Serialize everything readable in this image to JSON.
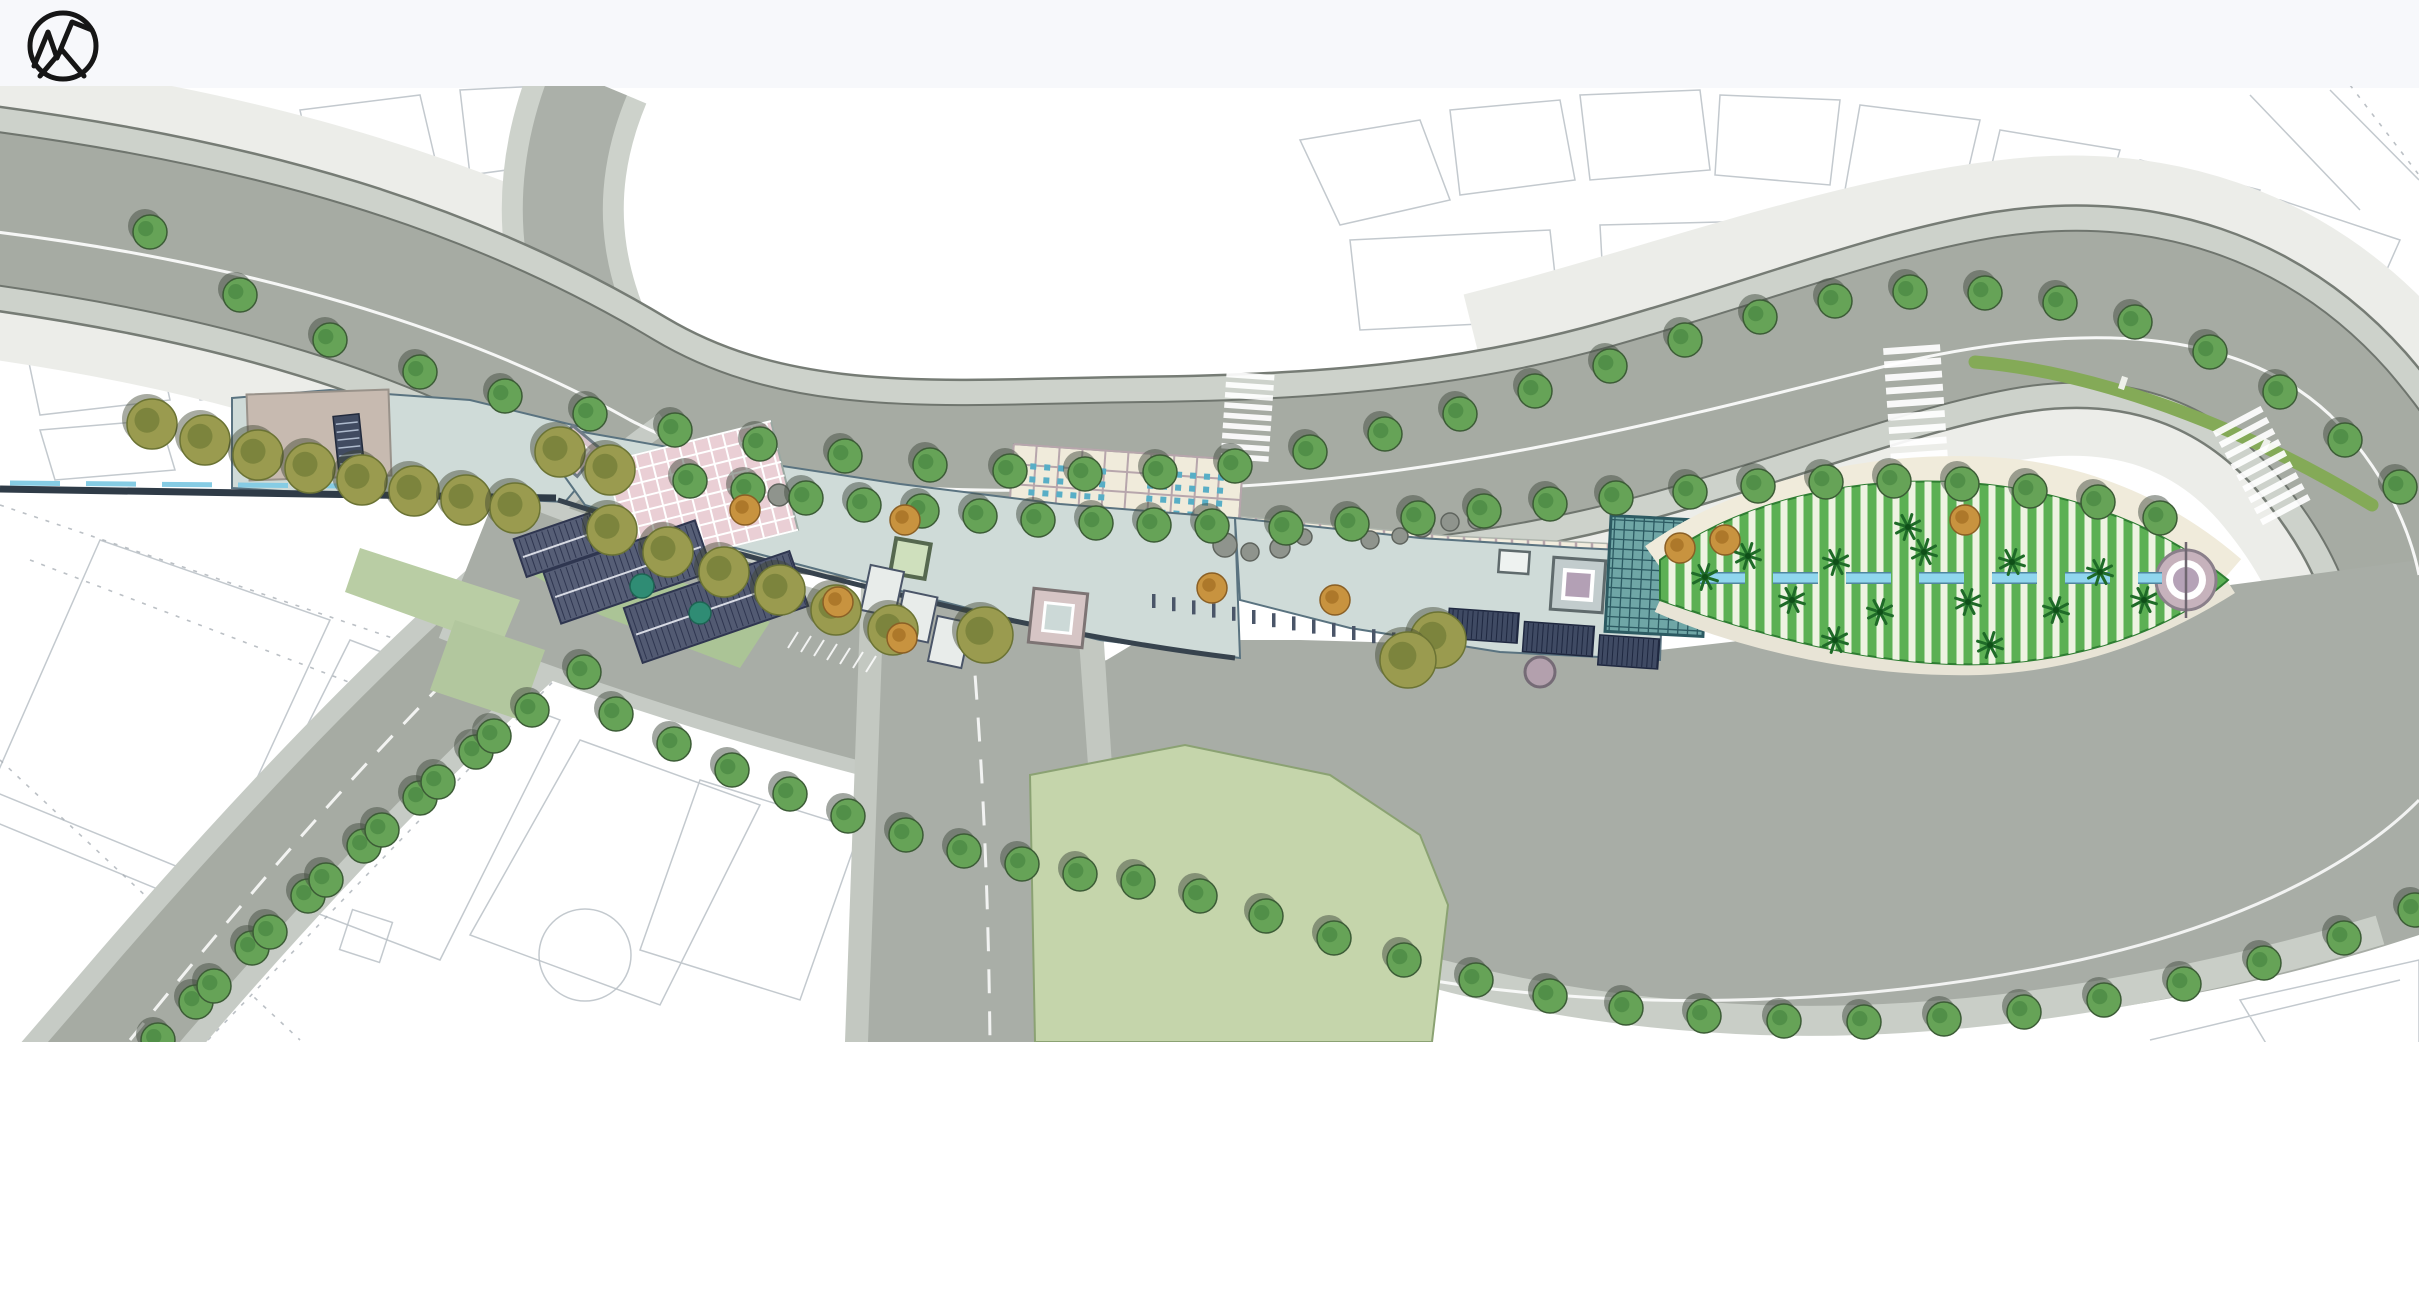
{
  "page": {
    "background": "#ffffff",
    "top_band": "#f7f8fb"
  },
  "logo": {
    "name": "compass-logo"
  },
  "legend": {
    "items": [
      {
        "num": "1",
        "label": "建筑"
      },
      {
        "num": "2",
        "label": "牌坊门"
      },
      {
        "num": "3",
        "label": "城墙绿化"
      },
      {
        "num": "4",
        "label": "特色铺装"
      },
      {
        "num": "5",
        "label": "鼓台"
      },
      {
        "num": "6",
        "label": "城墙休息平台"
      },
      {
        "num": "7",
        "label": "文化雕塑墙"
      },
      {
        "num": "8",
        "label": "配套服务"
      },
      {
        "num": "9",
        "label": "古文化特色经营"
      },
      {
        "num": "10",
        "label": "临时停车场"
      },
      {
        "num": "11",
        "label": "无障碍通道"
      },
      {
        "num": "12",
        "label": "景观树"
      },
      {
        "num": "13",
        "label": "观景木平台"
      },
      {
        "num": "14",
        "label": "保留雕塑"
      },
      {
        "num": "15",
        "label": "城墙展示空间"
      },
      {
        "num": "16",
        "label": "青砖步道"
      },
      {
        "num": "17",
        "label": "生态平台"
      },
      {
        "num": "18",
        "label": "花池座椅"
      },
      {
        "num": "19",
        "label": "城门入口广场"
      },
      {
        "num": "20",
        "label": "水中灯饰"
      },
      {
        "num": "21",
        "label": "摩岩石刻"
      },
      {
        "num": "22",
        "label": "旅游服务商店"
      },
      {
        "num": "23",
        "label": "小型文化广场"
      },
      {
        "num": "24",
        "label": "消防水池"
      },
      {
        "num": "25",
        "label": "钟台"
      },
      {
        "num": "26",
        "label": "入口庭院"
      },
      {
        "num": "27",
        "label": "人行横道"
      },
      {
        "num": "28",
        "label": "动感玻璃喷泉雕塑"
      },
      {
        "num": "29",
        "label": "城门雕塑"
      },
      {
        "num": "30",
        "label": "中心旱喷"
      },
      {
        "num": "31",
        "label": "公园入口大厅"
      }
    ]
  },
  "table": {
    "title": "主要经济技术指标",
    "headers": [
      "序号",
      "工程名称",
      "面积（m²）",
      "备注"
    ],
    "rows": [
      [
        "1",
        "景观用地面积",
        "21342.6",
        "32亩"
      ],
      [
        "2",
        "硬质广场面积",
        "10178.3",
        ""
      ],
      [
        "3",
        "木平台面积",
        "208.7",
        ""
      ],
      [
        "4",
        "道路面积",
        "8138.4",
        ""
      ],
      [
        "5",
        "绿化面积",
        "2817.2",
        ""
      ],
      [
        "6",
        "绿化率",
        "13.2%",
        ""
      ]
    ]
  },
  "plan": {
    "markers": [
      {
        "n": "1",
        "x": 237,
        "y": 431
      },
      {
        "n": "2",
        "x": 350,
        "y": 426
      },
      {
        "n": "3",
        "x": 458,
        "y": 492
      },
      {
        "n": "4",
        "x": 492,
        "y": 456
      },
      {
        "n": "5",
        "x": 574,
        "y": 449
      },
      {
        "n": "6",
        "x": 722,
        "y": 494
      },
      {
        "n": "7",
        "x": 505,
        "y": 671
      },
      {
        "n": "8",
        "x": 631,
        "y": 549
      },
      {
        "n": "9",
        "x": 676,
        "y": 606
      },
      {
        "n": "10",
        "x": 827,
        "y": 656
      },
      {
        "n": "11",
        "x": 881,
        "y": 596
      },
      {
        "n": "12",
        "x": 987,
        "y": 636
      },
      {
        "n": "13",
        "x": 1061,
        "y": 621
      },
      {
        "n": "14",
        "x": 909,
        "y": 556
      },
      {
        "n": "15",
        "x": 1153,
        "y": 606
      },
      {
        "n": "16",
        "x": 1411,
        "y": 569
      },
      {
        "n": "17",
        "x": 1436,
        "y": 632
      },
      {
        "n": "18",
        "x": 1451,
        "y": 534
      },
      {
        "n": "19",
        "x": 1035,
        "y": 481
      },
      {
        "n": "20",
        "x": 1316,
        "y": 537
      },
      {
        "n": "21",
        "x": 1233,
        "y": 569
      },
      {
        "n": "22",
        "x": 1509,
        "y": 629
      },
      {
        "n": "23",
        "x": 1565,
        "y": 674
      },
      {
        "n": "24",
        "x": 1518,
        "y": 566
      },
      {
        "n": "25",
        "x": 1575,
        "y": 583
      },
      {
        "n": "26",
        "x": 1635,
        "y": 571
      },
      {
        "n": "27",
        "x": 1890,
        "y": 524
      },
      {
        "n": "28",
        "x": 2022,
        "y": 579
      },
      {
        "n": "29",
        "x": 2184,
        "y": 580
      },
      {
        "n": "30",
        "x": 1930,
        "y": 574
      },
      {
        "n": "31",
        "x": 1688,
        "y": 535
      }
    ],
    "survey_labels": [
      {
        "t": "291.40",
        "x": 298,
        "y": 168,
        "r": -58
      },
      {
        "t": "281.01",
        "x": 327,
        "y": 196,
        "r": -58
      },
      {
        "t": "272.45",
        "x": 1088,
        "y": 300,
        "r": -32
      },
      {
        "t": "272.36",
        "x": 1126,
        "y": 282,
        "r": -32
      },
      {
        "t": "274.69",
        "x": 1975,
        "y": 258,
        "r": 22
      },
      {
        "t": "265.89",
        "x": 2092,
        "y": 178,
        "r": 28
      },
      {
        "t": "273.36",
        "x": 2262,
        "y": 300,
        "r": 38
      },
      {
        "t": "268.17",
        "x": 1902,
        "y": 760,
        "r": 36
      },
      {
        "t": "268.02",
        "x": 1992,
        "y": 802,
        "r": 36
      },
      {
        "t": "269.10",
        "x": 1836,
        "y": 836,
        "r": 36
      },
      {
        "t": "267.62",
        "x": 1902,
        "y": 992,
        "r": 30
      },
      {
        "t": "266.81",
        "x": 2102,
        "y": 1008,
        "r": 34
      },
      {
        "t": "295.15",
        "x": 118,
        "y": 758,
        "r": -55
      },
      {
        "t": "292.20",
        "x": 562,
        "y": 842,
        "r": -72
      },
      {
        "t": "290.13",
        "x": 872,
        "y": 952,
        "r": -78
      },
      {
        "t": "270.57",
        "x": 764,
        "y": 902,
        "r": -82
      }
    ]
  },
  "colors": {
    "marker_red": "#ee1109",
    "road": "#a6aba3",
    "sidewalk": "#cdd2cb",
    "tree_green": "#66a357",
    "olive_tree": "#9a9b4f",
    "park_deck": "#cfdbd8",
    "cream_paving": "#f2edde",
    "pink_plaza": "#eacfd5",
    "island_green": "#5cb054",
    "field_green": "#c5d5ab",
    "water_blue": "#90d6ee",
    "roof_navy": "#565e76",
    "teal_court": "#6fa6a6",
    "median_green": "#84aa57"
  }
}
